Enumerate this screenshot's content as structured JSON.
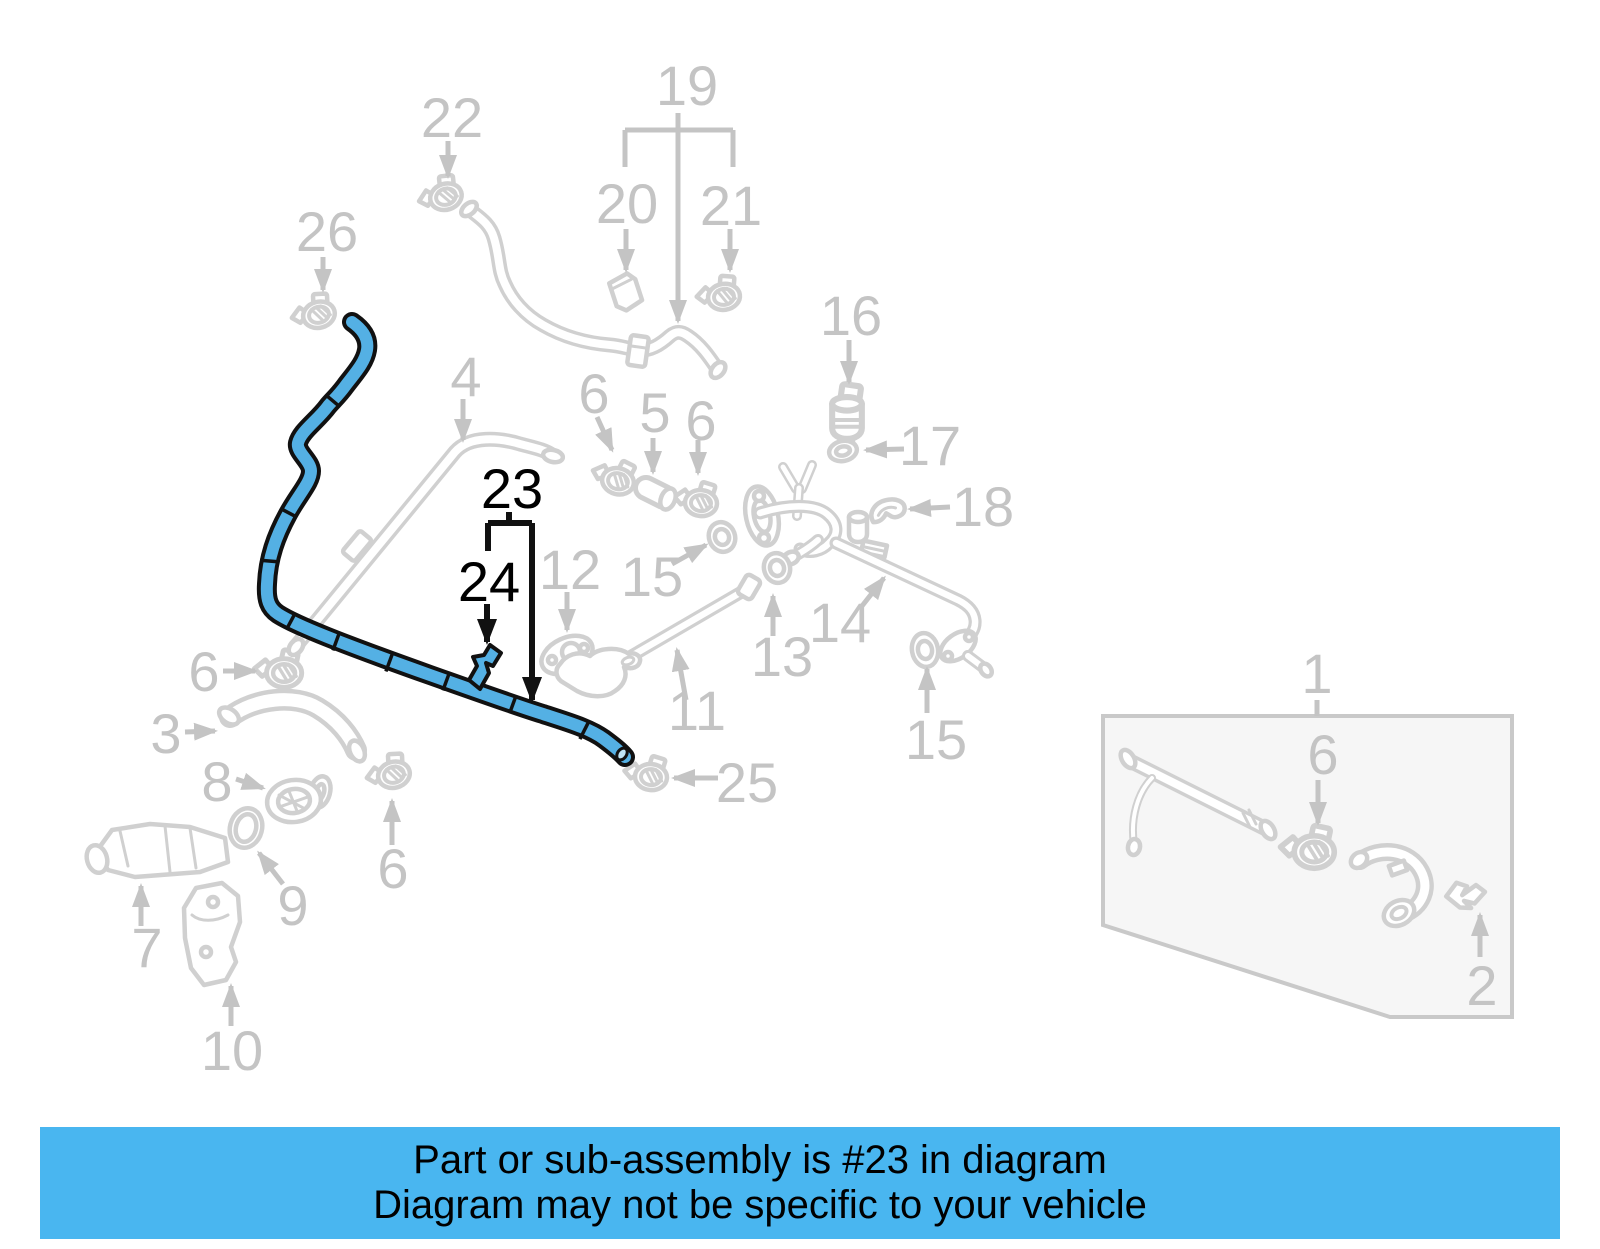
{
  "banner": {
    "line1": "Part or sub-assembly is #23 in diagram",
    "line2": "Diagram may not be specific to your vehicle",
    "bg_color": "#49b6f0",
    "text_color": "#000000"
  },
  "highlight": {
    "color": "#54b0e4",
    "outline_color": "#111111",
    "highlighted_parts": [
      "23",
      "24"
    ]
  },
  "diagram": {
    "label_color": "#c4c4c4",
    "art_color": "#d0d0d0",
    "emphasis_color": "#000000",
    "labels": [
      {
        "id": "label-22",
        "text": "22",
        "x": 452,
        "y": 117,
        "emphasis": false
      },
      {
        "id": "label-19",
        "text": "19",
        "x": 687,
        "y": 85,
        "emphasis": false
      },
      {
        "id": "label-20",
        "text": "20",
        "x": 627,
        "y": 203,
        "emphasis": false
      },
      {
        "id": "label-21",
        "text": "21",
        "x": 731,
        "y": 205,
        "emphasis": false
      },
      {
        "id": "label-26",
        "text": "26",
        "x": 327,
        "y": 231,
        "emphasis": false
      },
      {
        "id": "label-16",
        "text": "16",
        "x": 851,
        "y": 315,
        "emphasis": false
      },
      {
        "id": "label-4",
        "text": "4",
        "x": 466,
        "y": 376,
        "emphasis": false
      },
      {
        "id": "label-6a",
        "text": "6",
        "x": 594,
        "y": 393,
        "emphasis": false
      },
      {
        "id": "label-5",
        "text": "5",
        "x": 655,
        "y": 412,
        "emphasis": false
      },
      {
        "id": "label-6b",
        "text": "6",
        "x": 701,
        "y": 420,
        "emphasis": false
      },
      {
        "id": "label-17",
        "text": "17",
        "x": 930,
        "y": 445,
        "emphasis": false
      },
      {
        "id": "label-23",
        "text": "23",
        "x": 512,
        "y": 488,
        "emphasis": true
      },
      {
        "id": "label-18",
        "text": "18",
        "x": 983,
        "y": 506,
        "emphasis": false
      },
      {
        "id": "label-12",
        "text": "12",
        "x": 570,
        "y": 569,
        "emphasis": false
      },
      {
        "id": "label-15a",
        "text": "15",
        "x": 652,
        "y": 576,
        "emphasis": false
      },
      {
        "id": "label-24",
        "text": "24",
        "x": 489,
        "y": 581,
        "emphasis": true
      },
      {
        "id": "label-14",
        "text": "14",
        "x": 840,
        "y": 622,
        "emphasis": false
      },
      {
        "id": "label-13",
        "text": "13",
        "x": 782,
        "y": 656,
        "emphasis": false
      },
      {
        "id": "label-1",
        "text": "1",
        "x": 1317,
        "y": 673,
        "emphasis": false
      },
      {
        "id": "label-6c",
        "text": "6",
        "x": 204,
        "y": 671,
        "emphasis": false
      },
      {
        "id": "label-11",
        "text": "11",
        "x": 697,
        "y": 710,
        "emphasis": false
      },
      {
        "id": "label-3",
        "text": "3",
        "x": 166,
        "y": 733,
        "emphasis": false
      },
      {
        "id": "label-15b",
        "text": "15",
        "x": 936,
        "y": 739,
        "emphasis": false
      },
      {
        "id": "label-6d",
        "text": "6",
        "x": 1323,
        "y": 754,
        "emphasis": false
      },
      {
        "id": "label-8",
        "text": "8",
        "x": 217,
        "y": 781,
        "emphasis": false
      },
      {
        "id": "label-25",
        "text": "25",
        "x": 747,
        "y": 782,
        "emphasis": false
      },
      {
        "id": "label-6e",
        "text": "6",
        "x": 393,
        "y": 868,
        "emphasis": false
      },
      {
        "id": "label-9",
        "text": "9",
        "x": 293,
        "y": 905,
        "emphasis": false
      },
      {
        "id": "label-7",
        "text": "7",
        "x": 147,
        "y": 947,
        "emphasis": false
      },
      {
        "id": "label-2",
        "text": "2",
        "x": 1482,
        "y": 985,
        "emphasis": false
      },
      {
        "id": "label-10",
        "text": "10",
        "x": 232,
        "y": 1050,
        "emphasis": false
      }
    ]
  }
}
